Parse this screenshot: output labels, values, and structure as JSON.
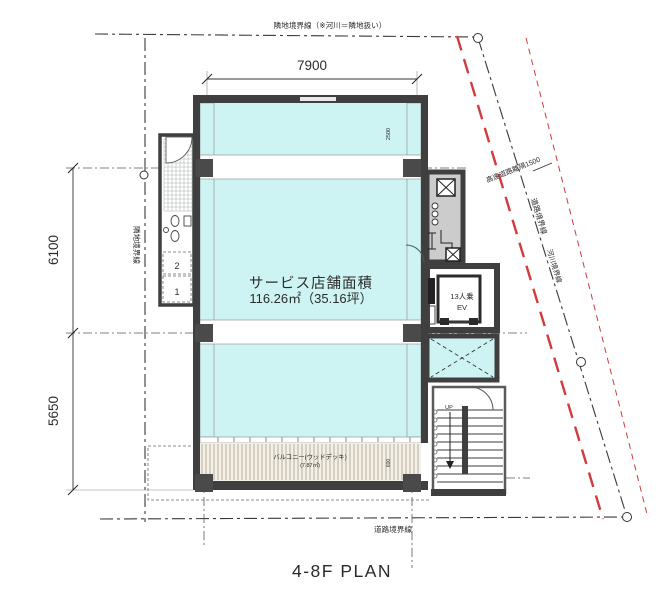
{
  "title": "4-8F PLAN",
  "room": {
    "name": "サービス店舗面積",
    "area": "116.26㎡（35.16坪）"
  },
  "elevator": {
    "capacity": "13人乗",
    "label": "EV"
  },
  "balcony": {
    "name": "バルコニー(ウッドデッキ)",
    "area": "(7.87㎡)"
  },
  "stairs": {
    "direction": "UP"
  },
  "wc": {
    "stall_upper": "2",
    "stall_lower": "1"
  },
  "dimensions": {
    "top_width": "7900",
    "left_upper": "6100",
    "left_lower": "5650",
    "upper_zone_depth": "2500",
    "balcony_depth": "600"
  },
  "boundaries": {
    "top": "隣地境界線（※河川＝隣地扱い）",
    "left": "隣地境界線",
    "bottom": "道路境界線",
    "diagonal_road": "道路境界線",
    "diagonal_river": "河川境界線",
    "highway_clearance": "高速道路離隔1500"
  },
  "colors": {
    "room_fill": "#cdf4f2",
    "wall": "#3f3f3f",
    "boundary_red": "#d23c3c",
    "deck_line": "#b3a895"
  }
}
